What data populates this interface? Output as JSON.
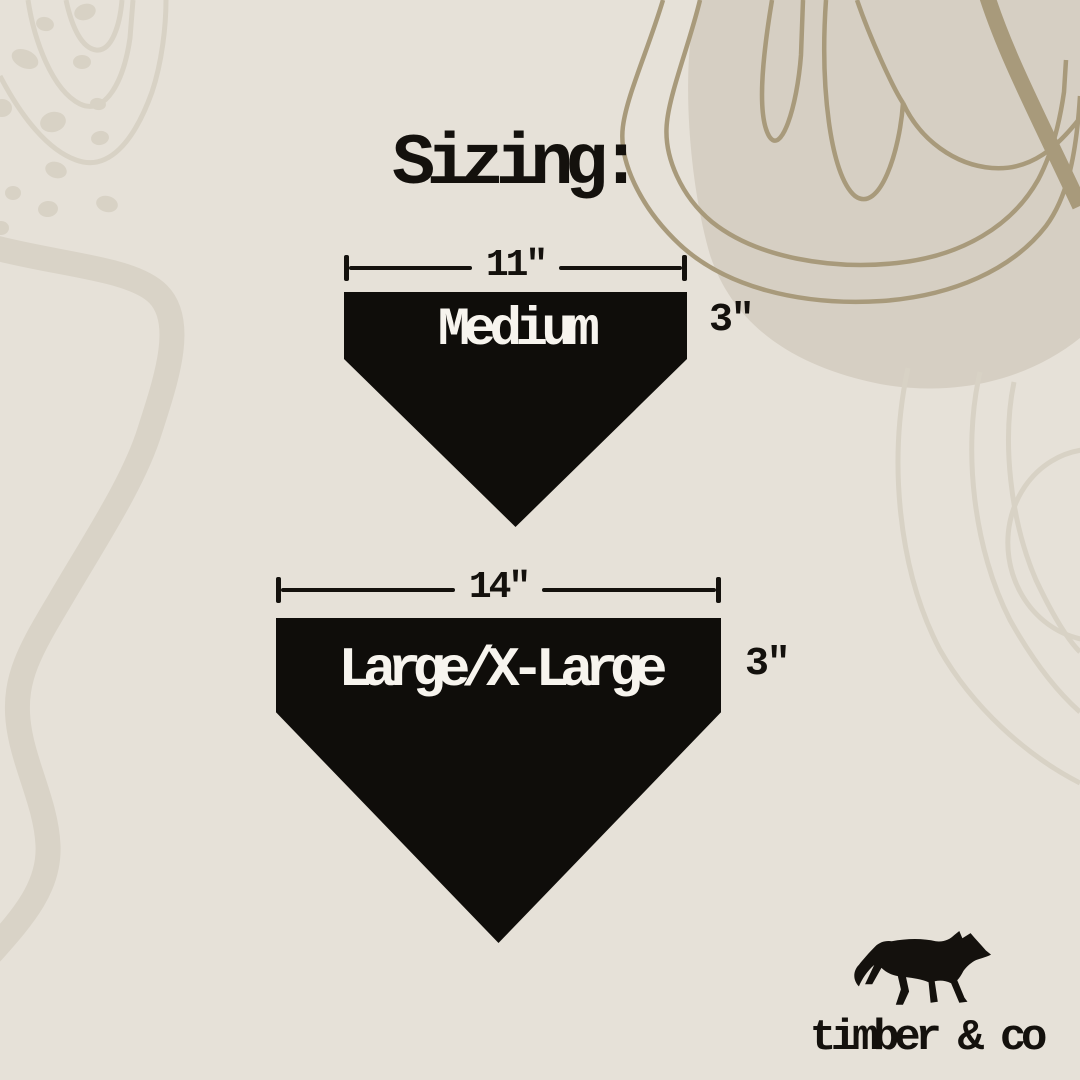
{
  "title": "Sizing:",
  "sizes": [
    {
      "name": "Medium",
      "width_label": "11\"",
      "side_label": "3\""
    },
    {
      "name": "Large/X-Large",
      "width_label": "14\"",
      "side_label": "3\""
    }
  ],
  "brand": {
    "name": "timber & co",
    "logo": "wolf-silhouette"
  },
  "colors": {
    "background": "#e6e1d8",
    "bandana_black": "#0f0d0a",
    "bandana_text_white": "#f7f4ee",
    "ink_black": "#14110d",
    "decoration_light": "#d8d2c5",
    "decoration_tan_blob": "#d6cfc3",
    "decoration_dark_line": "#a89a7b"
  }
}
